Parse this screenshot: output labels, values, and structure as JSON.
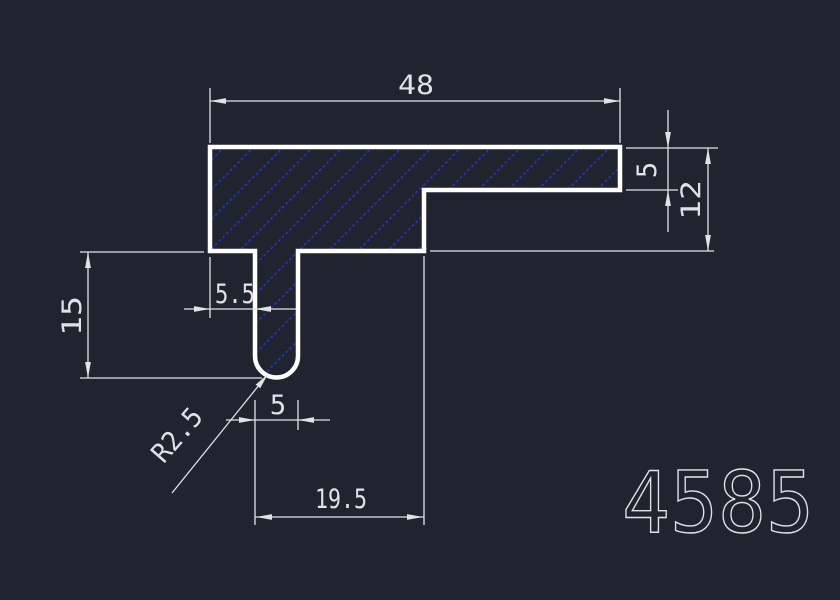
{
  "drawing": {
    "part_number": "4585",
    "dimensions": {
      "overall_width": "48",
      "flange_thickness": "5",
      "body_depth": "12",
      "leg_length": "15",
      "web_offset": "5.5",
      "leg_width": "5",
      "leg_to_step_distance": "19.5",
      "corner_radius": "R2.5"
    },
    "colors": {
      "background": "#20242f",
      "outline": "#ffffff",
      "hatch": "#2636d8",
      "dimension": "#dfe3e8"
    },
    "hatch_style": "diagonal-dotted-45deg"
  }
}
